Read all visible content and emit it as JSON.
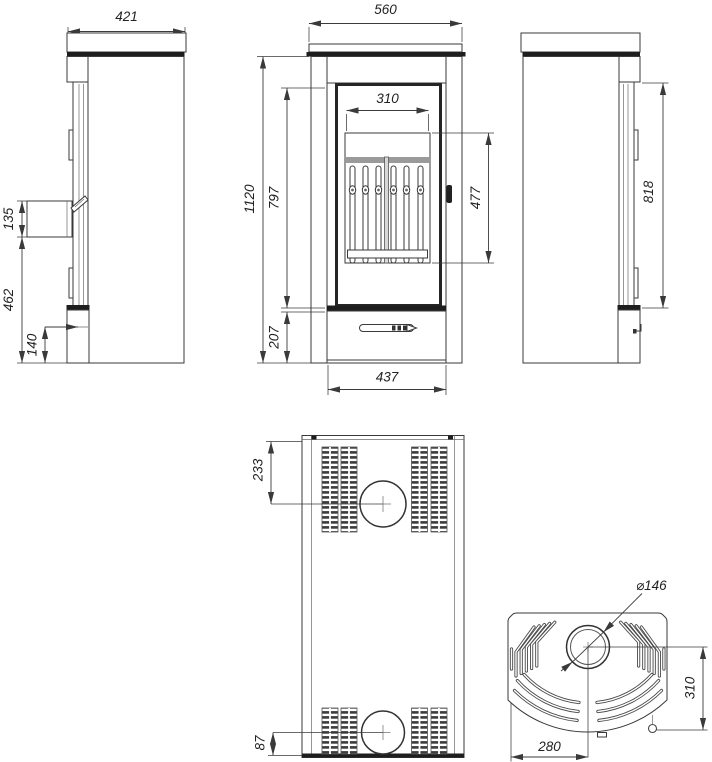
{
  "drawing": {
    "kind": "technical dimension drawing",
    "subject": "free-standing wood-burning stove shown in five orthographic views",
    "views": [
      "left side view",
      "front view",
      "right side view",
      "rear view",
      "top view"
    ]
  },
  "colors": {
    "background": "#ffffff",
    "line": "#3a3a3a",
    "dark_fill": "#1e1e1e",
    "text": "#222222"
  },
  "views": {
    "side_left": {
      "label": "left side view",
      "dims": {
        "top_width": "421",
        "handle_box_height": "135",
        "front_lower_height": "462",
        "plinth_height": "140"
      }
    },
    "front": {
      "label": "front view",
      "dims": {
        "top_width": "560",
        "total_height": "1120",
        "door_height": "797",
        "base_height": "207",
        "glass_width": "310",
        "glass_height": "477",
        "body_width": "437"
      }
    },
    "side_right": {
      "label": "right side view",
      "dims": {
        "door_height": "818"
      }
    },
    "rear": {
      "label": "rear view",
      "dims": {
        "flue_center_from_top": "233",
        "inlet_center_from_bottom": "87"
      }
    },
    "top": {
      "label": "top view",
      "dims": {
        "flue_diameter": "⌀146",
        "flue_center_to_front": "310",
        "flue_center_from_left": "280"
      }
    }
  }
}
